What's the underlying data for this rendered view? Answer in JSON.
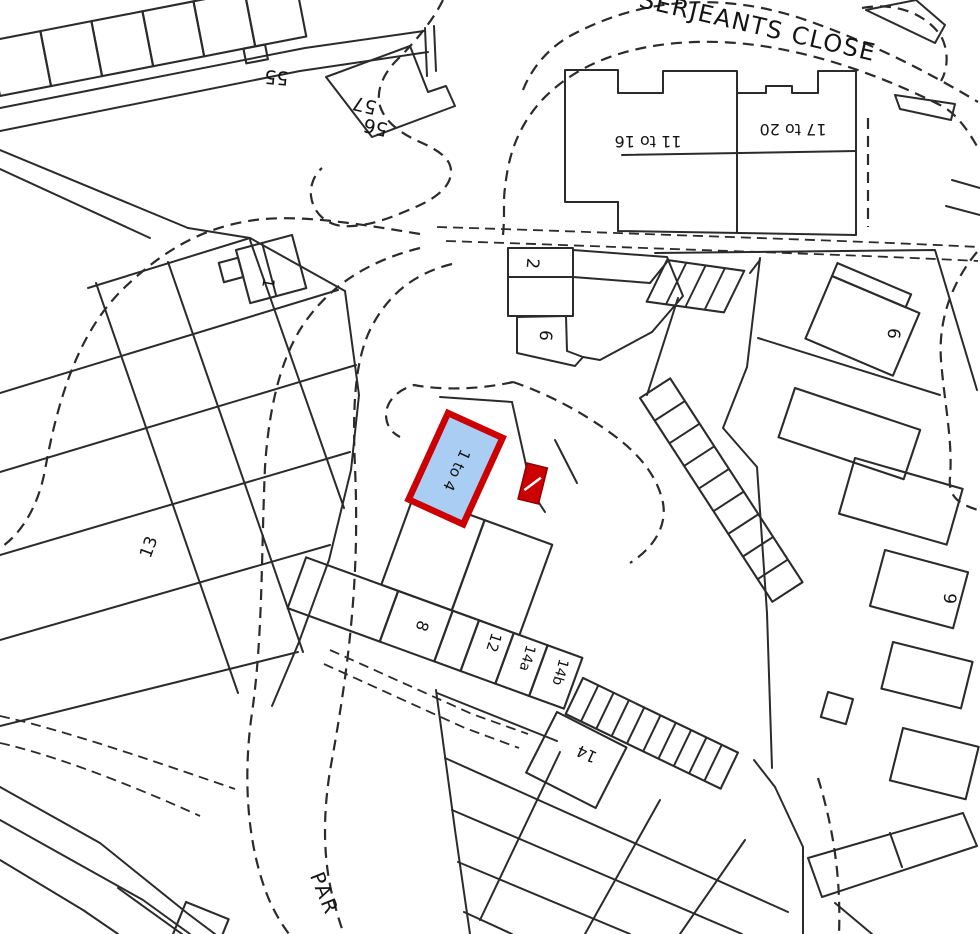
{
  "map": {
    "background": "#ffffff",
    "line_color": "#2b2b2b",
    "highlight": {
      "label": "1 to 4",
      "fill": "#a9cdf3",
      "stroke": "#cc0000",
      "outbuilding_fill": "#cc0000"
    },
    "street_labels": [
      {
        "id": "serjeants-close",
        "text": "SERJEANTS CLOSE",
        "x": 756,
        "y": 34,
        "rotate": 13,
        "size": 24,
        "spacing": 1.5
      },
      {
        "id": "park-street-partial",
        "text": "PAR",
        "x": 318,
        "y": 896,
        "rotate": 68,
        "size": 20,
        "spacing": 2
      }
    ],
    "plot_labels": [
      {
        "id": "plot-55",
        "text": "55",
        "x": 277,
        "y": 71,
        "rotate": 185,
        "size": 19
      },
      {
        "id": "plot-57",
        "text": "57",
        "x": 366,
        "y": 99,
        "rotate": 193,
        "size": 19
      },
      {
        "id": "plot-56",
        "text": "56",
        "x": 377,
        "y": 121,
        "rotate": 193,
        "size": 19
      },
      {
        "id": "plot-1",
        "text": "1",
        "x": 263,
        "y": 282,
        "rotate": 100,
        "size": 16
      },
      {
        "id": "plot-13",
        "text": "13",
        "x": 154,
        "y": 549,
        "rotate": -70,
        "size": 17
      },
      {
        "id": "plot-2",
        "text": "2",
        "x": 527,
        "y": 263,
        "rotate": 95,
        "size": 17
      },
      {
        "id": "plot-6-mid",
        "text": "6",
        "x": 540,
        "y": 335,
        "rotate": 95,
        "size": 17
      },
      {
        "id": "plot-11-16",
        "text": "11 to 16",
        "x": 648,
        "y": 136,
        "rotate": 180,
        "size": 16
      },
      {
        "id": "plot-17-20",
        "text": "17 to 20",
        "x": 793,
        "y": 124,
        "rotate": 180,
        "size": 16
      },
      {
        "id": "plot-1-to-4-highlight",
        "text": "1 to 4",
        "x": 452,
        "y": 468,
        "rotate": 115,
        "size": 15
      },
      {
        "id": "plot-8",
        "text": "8",
        "x": 417,
        "y": 624,
        "rotate": 110,
        "size": 16
      },
      {
        "id": "plot-12",
        "text": "12",
        "x": 489,
        "y": 641,
        "rotate": 108,
        "size": 15
      },
      {
        "id": "plot-14a",
        "text": "14a",
        "x": 523,
        "y": 657,
        "rotate": 106,
        "size": 14
      },
      {
        "id": "plot-14b",
        "text": "14b",
        "x": 556,
        "y": 671,
        "rotate": 106,
        "size": 14
      },
      {
        "id": "plot-14",
        "text": "14",
        "x": 589,
        "y": 749,
        "rotate": 205,
        "size": 16
      },
      {
        "id": "plot-6-right",
        "text": "6",
        "x": 888,
        "y": 333,
        "rotate": 95,
        "size": 17
      },
      {
        "id": "plot-9",
        "text": "9",
        "x": 944,
        "y": 598,
        "rotate": 95,
        "size": 17
      }
    ]
  }
}
